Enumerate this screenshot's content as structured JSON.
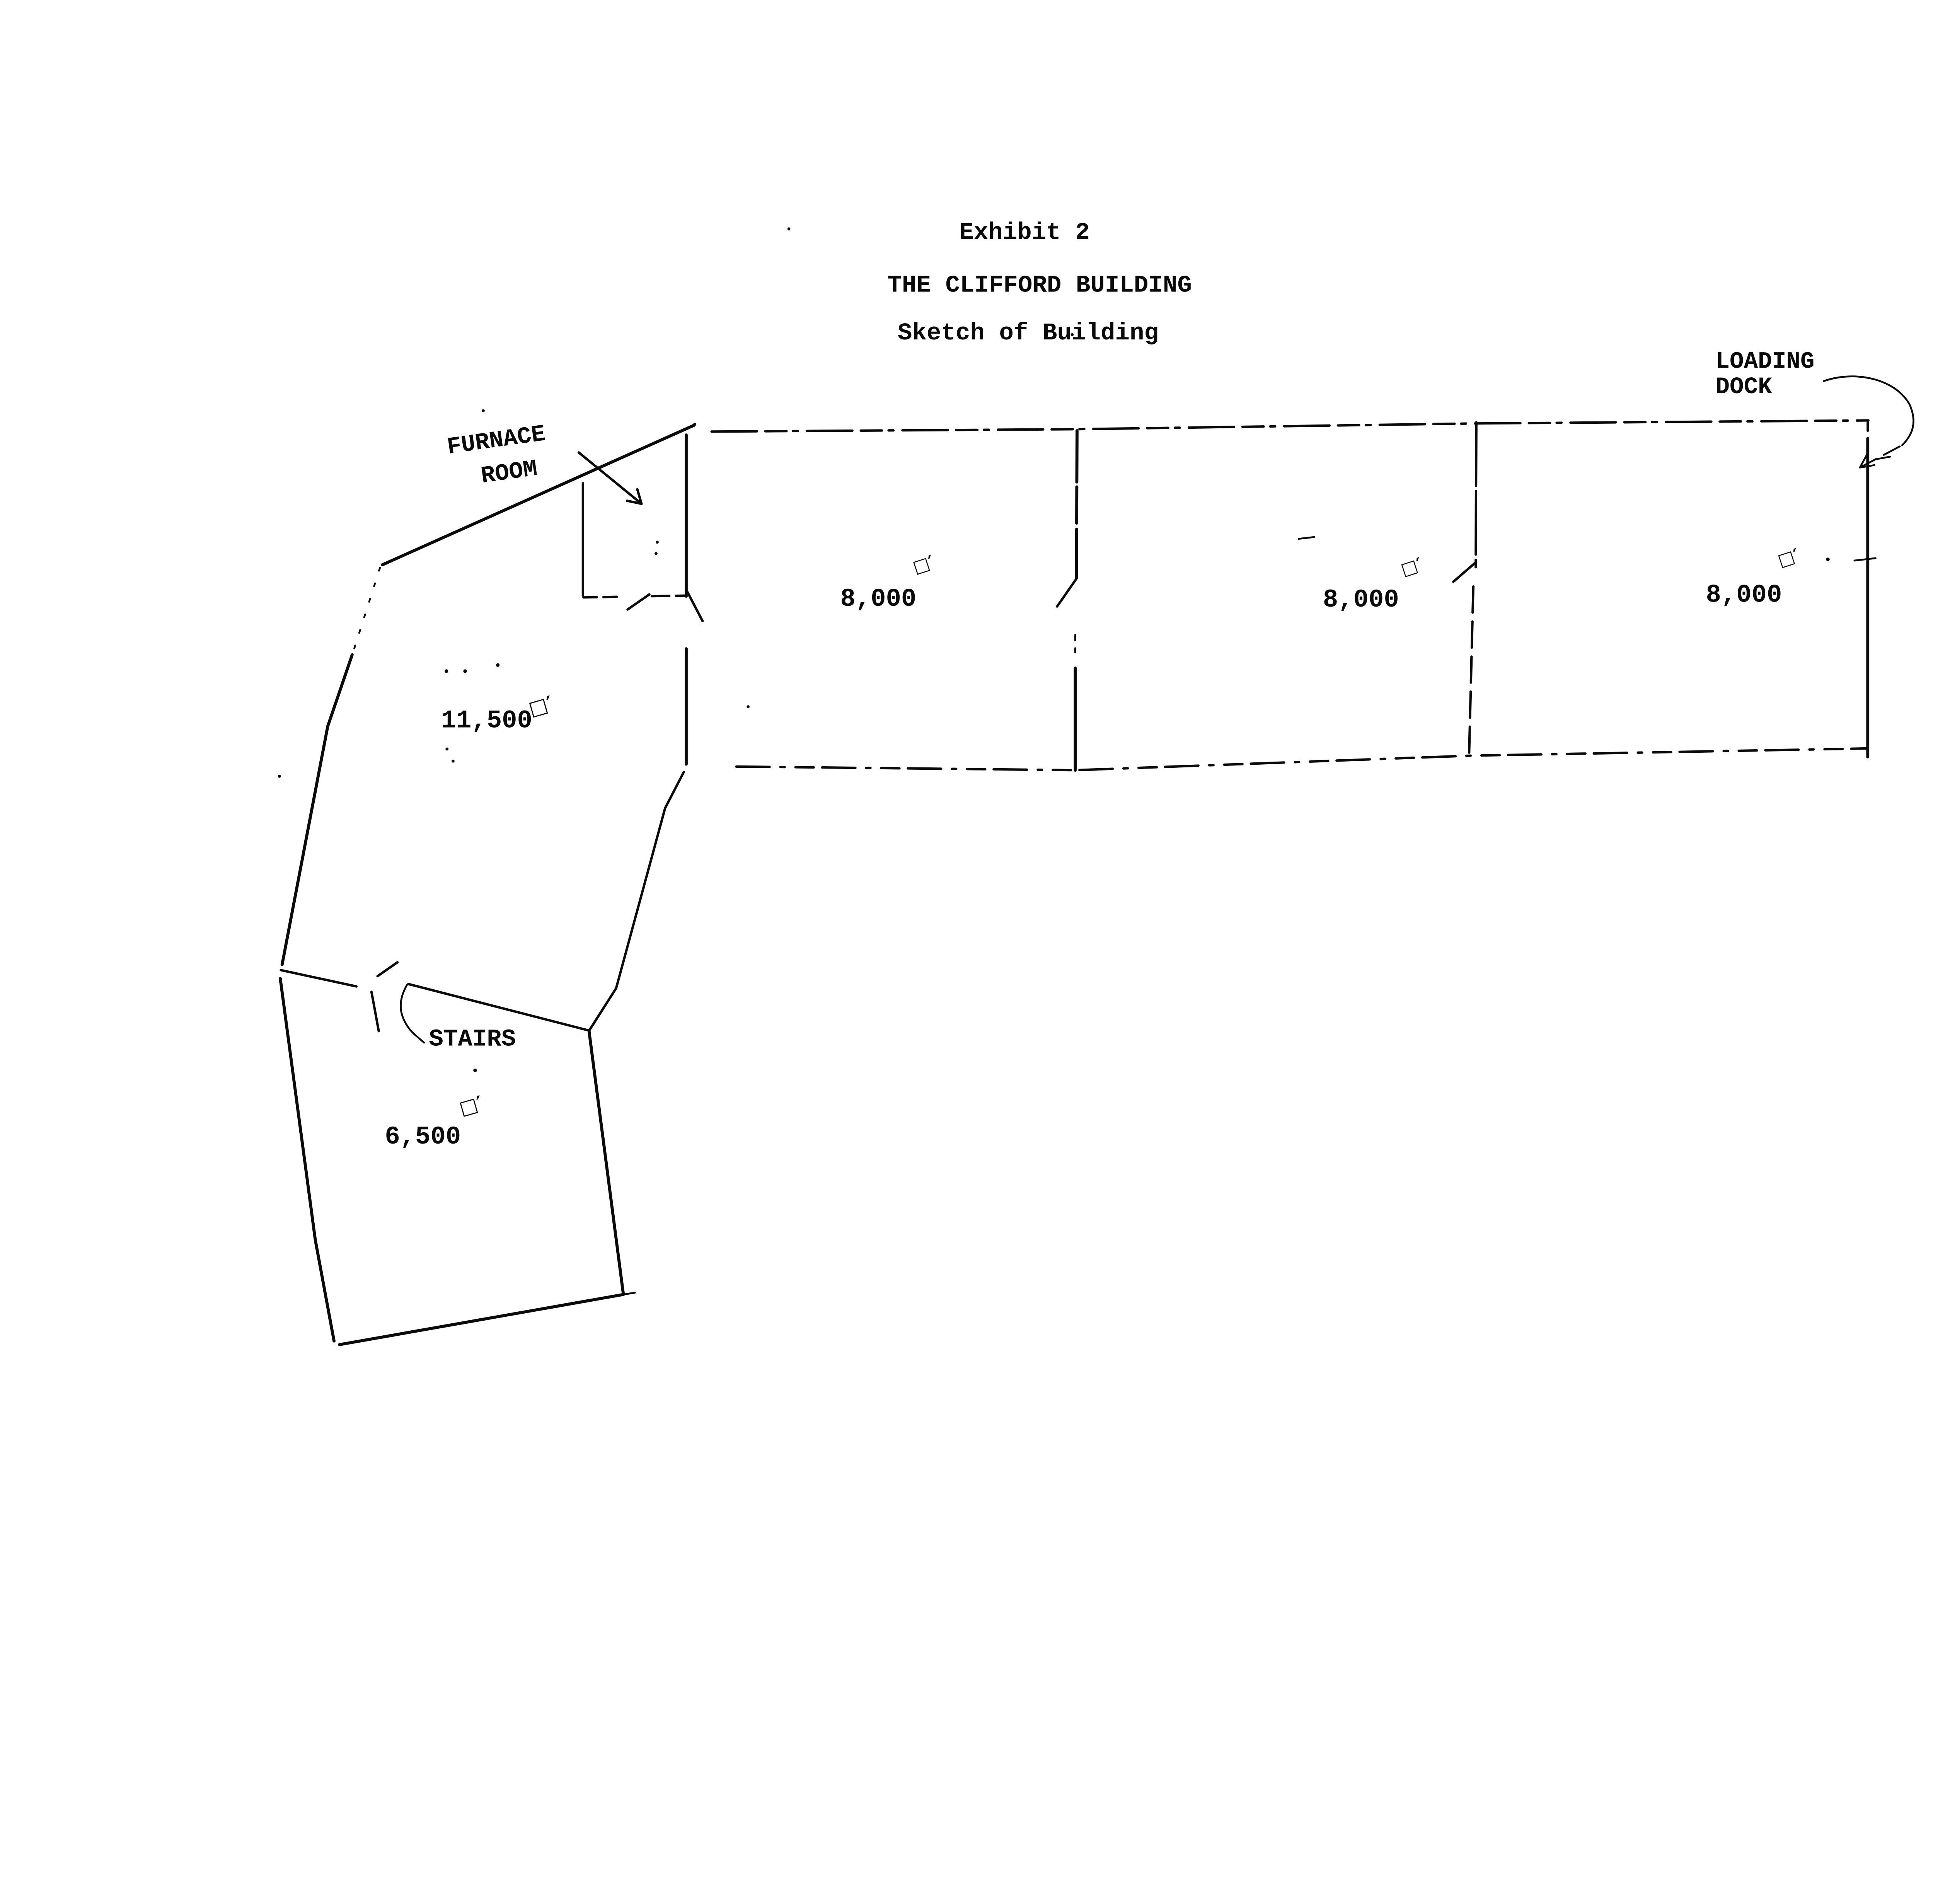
{
  "page": {
    "paper_color": "#ffffff",
    "ink_color": "#0a0a0a"
  },
  "document": {
    "exhibit_label": "Exhibit 2",
    "title": "THE CLIFFORD BUILDING",
    "subtitle": "Sketch of Building"
  },
  "sketch": {
    "unit_symbol": "□′",
    "annotations": {
      "furnace_line1": "FURNACE",
      "furnace_line2": "ROOM",
      "loading_line1": "LOADING",
      "loading_line2": "DOCK",
      "stairs": "STAIRS"
    },
    "areas": {
      "bay1": "8,000",
      "bay2": "8,000",
      "bay3": "8,000",
      "main_section": "11,500",
      "lower_section": "6,500"
    }
  }
}
